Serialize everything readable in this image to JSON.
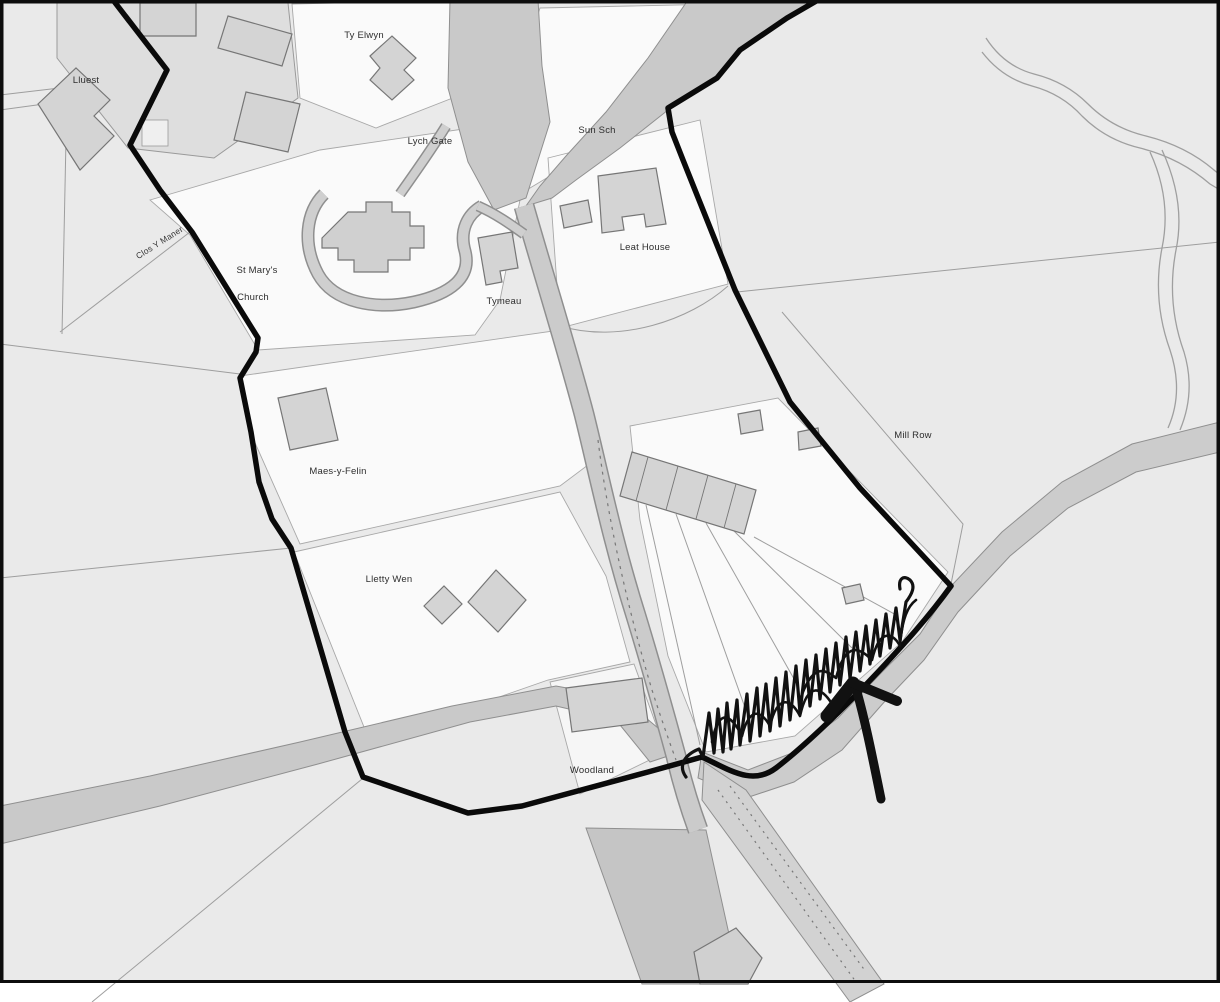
{
  "map": {
    "title": "Village conservation boundary map",
    "labels": [
      {
        "id": "lluest",
        "text": "Lluest"
      },
      {
        "id": "ty-elwyn",
        "text": "Ty Elwyn"
      },
      {
        "id": "lych-gate",
        "text": "Lych Gate"
      },
      {
        "id": "sun-sch",
        "text": "Sun Sch"
      },
      {
        "id": "leat-house",
        "text": "Leat House"
      },
      {
        "id": "st-marys",
        "text": "St Mary's"
      },
      {
        "id": "church",
        "text": "Church"
      },
      {
        "id": "clos-y-maner",
        "text": "Clos Y Maner"
      },
      {
        "id": "tymeau",
        "text": "Tymeau"
      },
      {
        "id": "maes-y-felin",
        "text": "Maes-y-Felin"
      },
      {
        "id": "mill-row",
        "text": "Mill Row"
      },
      {
        "id": "lletty-wen",
        "text": "Lletty Wen"
      },
      {
        "id": "woodland",
        "text": "Woodland"
      }
    ],
    "annotations": {
      "scribble": "hand-drawn marker scribble along south-east boundary",
      "arrow": "hand-drawn arrow pointing at boundary line"
    },
    "colors": {
      "background": "#eaeaea",
      "parcel_white": "#fafafa",
      "road": "#c9c9c9",
      "building": "#d4d4d4",
      "boundary": "#0a0a0a",
      "annotation": "#111111"
    }
  }
}
